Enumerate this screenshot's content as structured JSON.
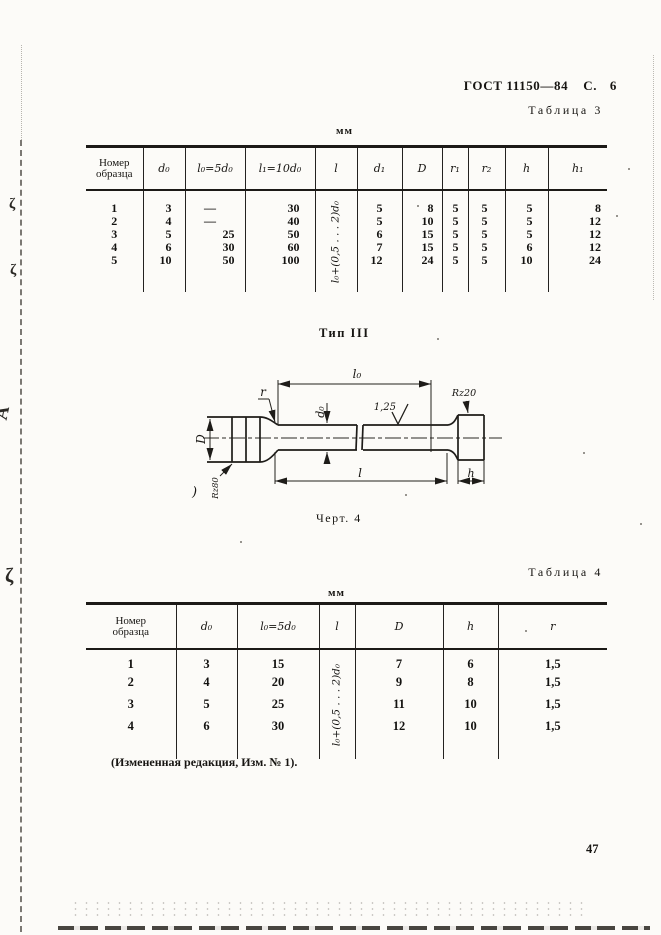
{
  "header": {
    "standard": "ГОСТ 11150—84",
    "page_label": "С. 6"
  },
  "table3": {
    "caption": "Таблица 3",
    "unit": "мм",
    "col_headers": [
      "Номер образца",
      "d₀",
      "l₀=5d₀",
      "l₁=10d₀",
      "l",
      "d₁",
      "D",
      "r₁",
      "r₂",
      "h",
      "h₁"
    ],
    "l_formula": "l₀+(0,5 . . . 2)d₀",
    "rows": [
      [
        "1",
        "3",
        "—",
        "30",
        "5",
        "8",
        "5",
        "5",
        "5",
        "8"
      ],
      [
        "2",
        "4",
        "—",
        "40",
        "5",
        "10",
        "5",
        "5",
        "5",
        "12"
      ],
      [
        "3",
        "5",
        "25",
        "50",
        "6",
        "15",
        "5",
        "5",
        "5",
        "12"
      ],
      [
        "4",
        "6",
        "30",
        "60",
        "7",
        "15",
        "5",
        "5",
        "6",
        "12"
      ],
      [
        "5",
        "10",
        "50",
        "100",
        "12",
        "24",
        "5",
        "5",
        "10",
        "24"
      ]
    ]
  },
  "figure": {
    "type_label": "Тип III",
    "caption": "Черт. 4",
    "labels": {
      "l0": "l₀",
      "r": "r",
      "d0": "d₀",
      "roughness": "1,25",
      "rz20": "Rz20",
      "D": "D",
      "l": "l",
      "h": "h",
      "rz80": "Rz80"
    },
    "artifact_paren": ")"
  },
  "table4": {
    "caption": "Таблица 4",
    "unit": "мм",
    "col_headers": [
      "Номер образца",
      "d₀",
      "l₀=5d₀",
      "l",
      "D",
      "h",
      "r"
    ],
    "l_formula": "l₀+(0,5 . . . 2)d₀",
    "rows": [
      [
        "1",
        "3",
        "15",
        "7",
        "6",
        "1,5"
      ],
      [
        "2",
        "4",
        "20",
        "9",
        "8",
        "1,5"
      ],
      [
        "3",
        "5",
        "25",
        "11",
        "10",
        "1,5"
      ],
      [
        "4",
        "6",
        "30",
        "12",
        "10",
        "1,5"
      ]
    ]
  },
  "footnote": "(Измененная редакция, Изм. № 1).",
  "page_number": "47",
  "artifacts": {
    "curl": "ζ",
    "wedge": "A"
  }
}
